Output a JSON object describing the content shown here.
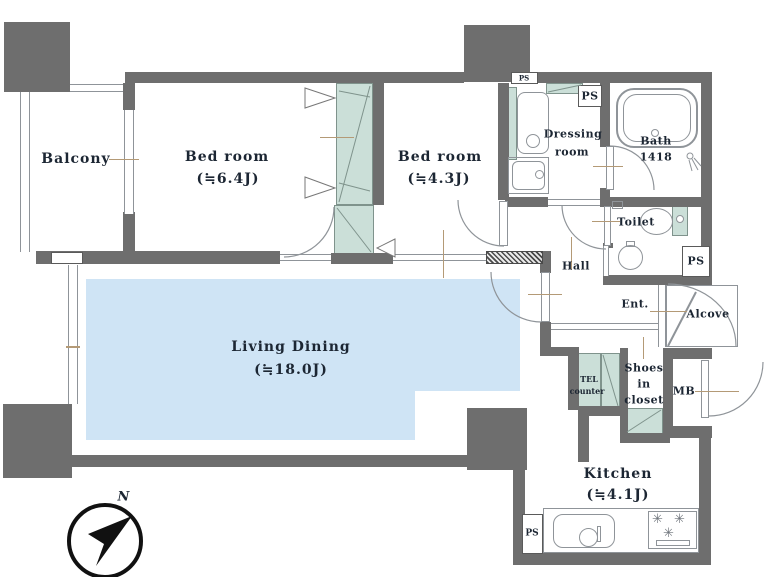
{
  "rooms": {
    "balcony": {
      "label": "Balcony"
    },
    "bedroom1": {
      "label": "Bed room",
      "size": "(≒6.4J)"
    },
    "bedroom2": {
      "label": "Bed room",
      "size": "(≒4.3J)"
    },
    "living": {
      "label": "Living Dining",
      "size": "(≒18.0J)"
    },
    "kitchen": {
      "label": "Kitchen",
      "size": "(≒4.1J)"
    },
    "dressing": {
      "label_line1": "Dressing",
      "label_line2": "room"
    },
    "bath": {
      "label": "Bath",
      "size": "1418"
    },
    "toilet": {
      "label": "Toilet"
    },
    "hall": {
      "label": "Hall"
    },
    "entrance": {
      "label": "Ent."
    },
    "alcove": {
      "label": "Alcove"
    },
    "shoes_closet": {
      "label_line1": "Shoes",
      "label_line2": "in",
      "label_line3": "closet"
    },
    "tel_counter": {
      "label_line1": "TEL",
      "label_line2": "counter"
    },
    "meter_box": {
      "label": "MB"
    },
    "pipe_space": {
      "label": "PS"
    }
  },
  "compass": {
    "label": "N"
  },
  "icons": {
    "burner": "✳"
  },
  "colors": {
    "wall": "#6e6e6e",
    "living": "#cfe4f5",
    "closet": "#cbdfd8",
    "text": "#1c2633",
    "leader": "#b49a76"
  }
}
